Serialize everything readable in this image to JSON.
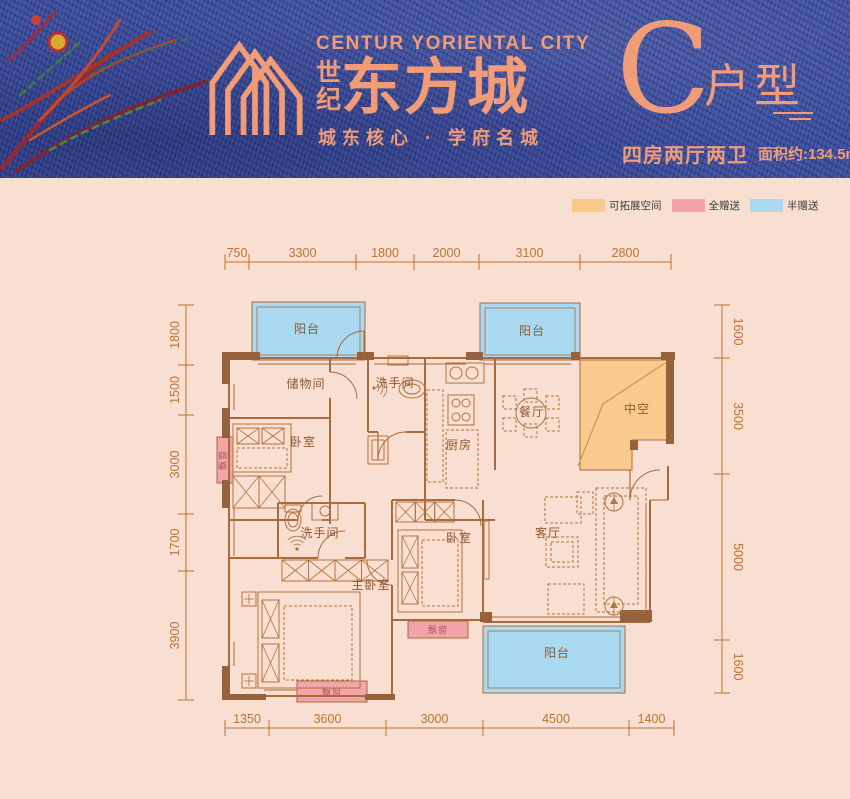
{
  "header": {
    "brand": {
      "en": "CENTUR YORIENTAL CITY",
      "cn_small_top": "世",
      "cn_small_bottom": "纪",
      "cn_main": "东方城",
      "tagline": "城东核心 · 学府名城"
    },
    "unit": {
      "letter": "C",
      "suffix": "户型",
      "rooms": "四房两厅两卫",
      "area": "面积约:134.5m²"
    }
  },
  "legend": {
    "items": [
      {
        "name": "expandable-space",
        "label": "可拓展空间",
        "color": "#F9C98E"
      },
      {
        "name": "fully-gifted",
        "label": "全赠送",
        "color": "#F2A4A9"
      },
      {
        "name": "half-gifted",
        "label": "半赠送",
        "color": "#A9DAF2"
      }
    ]
  },
  "floor_plan": {
    "rooms": [
      {
        "name": "balcony-north-west",
        "label": "阳台",
        "x": 307,
        "y": 333
      },
      {
        "name": "balcony-north-east",
        "label": "阳台",
        "x": 532,
        "y": 335
      },
      {
        "name": "void-atrium",
        "label": "中空",
        "x": 637,
        "y": 413
      },
      {
        "name": "storage-room",
        "label": "储物间",
        "x": 306,
        "y": 388
      },
      {
        "name": "bathroom-north",
        "label": "洗手间",
        "x": 395,
        "y": 387
      },
      {
        "name": "kitchen",
        "label": "厨房",
        "x": 459,
        "y": 449
      },
      {
        "name": "dining-room",
        "label": "餐厅",
        "x": 532,
        "y": 416
      },
      {
        "name": "bedroom-north-west",
        "label": "卧室",
        "x": 303,
        "y": 446
      },
      {
        "name": "bathroom-south",
        "label": "洗手间",
        "x": 320,
        "y": 537
      },
      {
        "name": "master-bedroom",
        "label": "主卧室",
        "x": 371,
        "y": 589
      },
      {
        "name": "bedroom-middle",
        "label": "卧室",
        "x": 459,
        "y": 542
      },
      {
        "name": "living-room",
        "label": "客厅",
        "x": 548,
        "y": 537
      },
      {
        "name": "balcony-south",
        "label": "阳台",
        "x": 557,
        "y": 657
      }
    ],
    "bay_windows": [
      {
        "name": "bay-window-middle",
        "label": "飘窗",
        "x": 438,
        "y": 633,
        "rot": 0
      },
      {
        "name": "bay-window-south",
        "label": "飘窗",
        "x": 332,
        "y": 695,
        "rot": 0
      },
      {
        "name": "bay-window-west",
        "label": "飘窗",
        "x": 226,
        "y": 460,
        "rot": -90
      }
    ],
    "dimensions": {
      "top": [
        "750",
        "3300",
        "1800",
        "2000",
        "3100",
        "2800"
      ],
      "bottom": [
        "1350",
        "3600",
        "3000",
        "4500",
        "1400"
      ],
      "left": [
        "1800",
        "1500",
        "3000",
        "1700",
        "3900"
      ],
      "right": [
        "1600",
        "3500",
        "5000",
        "1600"
      ]
    },
    "colors": {
      "plan_background": "#F8DFD2",
      "header_background": "#3D4E9D",
      "brand_accent": "#F19B77",
      "wall": "#96613B",
      "structure_line": "#AA6A3C",
      "furniture_line": "#B5713B",
      "dimension_line": "#C2712E",
      "room_label": "#8F5931",
      "bay_label": "#A35F55"
    }
  }
}
